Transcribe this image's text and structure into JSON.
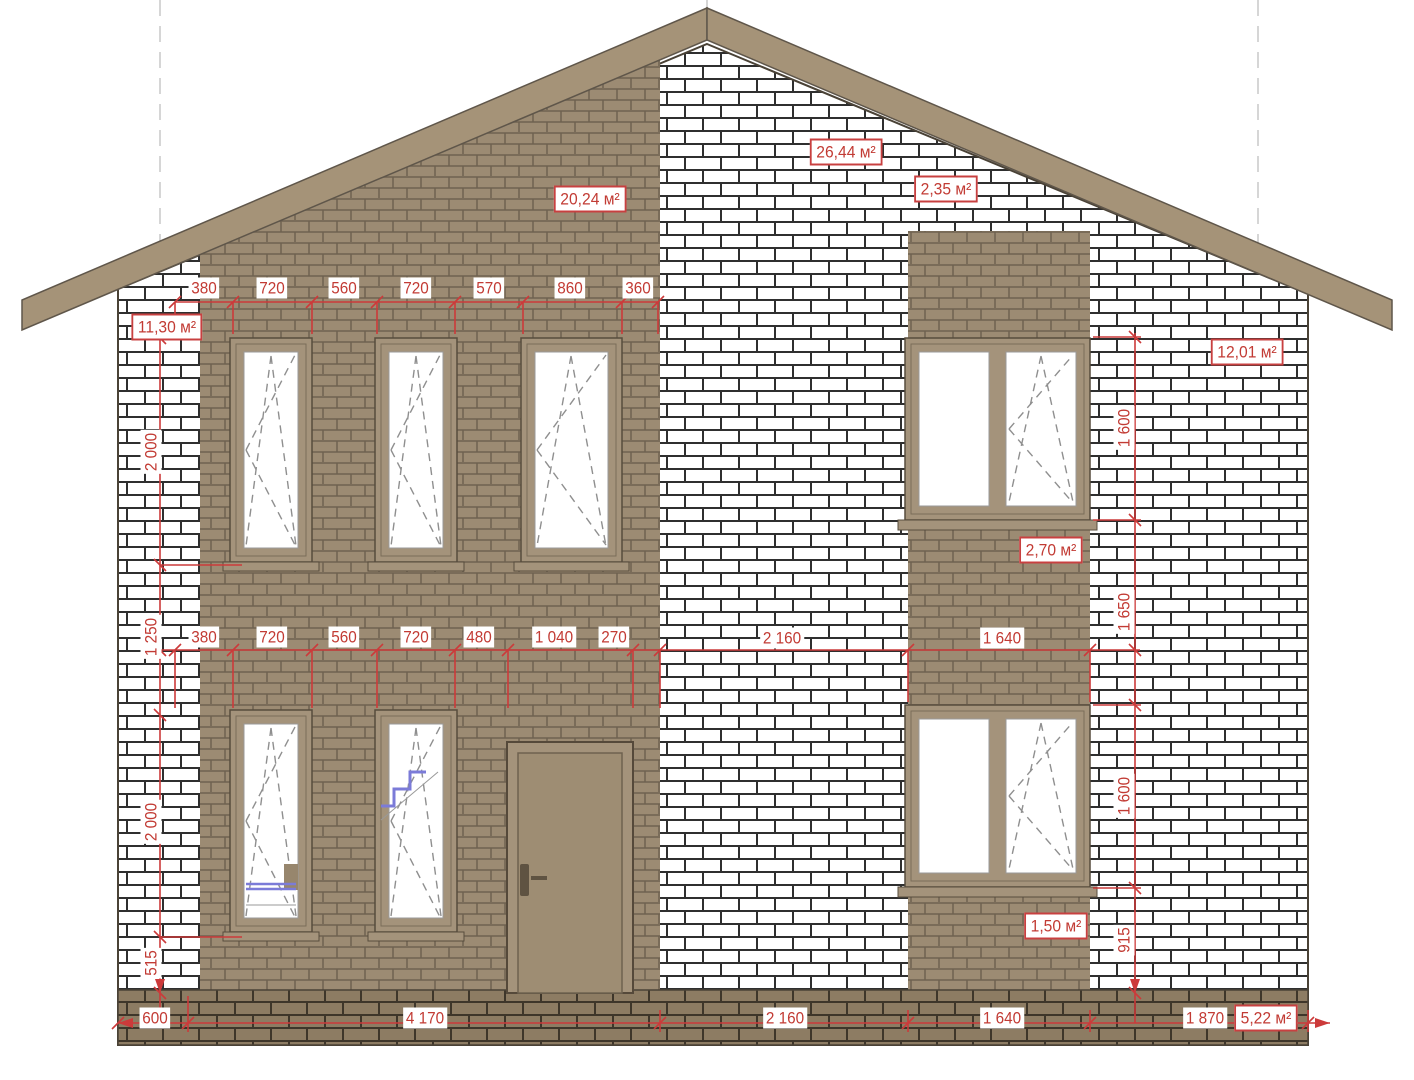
{
  "drawing": {
    "kind": "house facade elevation with brick cladding and dimensions",
    "units": "mm"
  },
  "dims": {
    "top": [
      "380",
      "720",
      "560",
      "720",
      "570",
      "860",
      "360"
    ],
    "middle": [
      "380",
      "720",
      "560",
      "720",
      "480",
      "1 040",
      "270",
      "2 160",
      "1 640"
    ],
    "bottom": [
      "600",
      "4 170",
      "2 160",
      "1 640",
      "1 870"
    ],
    "left": [
      "2 000",
      "1 250",
      "2 000",
      "515"
    ],
    "right": [
      "1 600",
      "1 650",
      "1 600",
      "915"
    ]
  },
  "areas": {
    "a1130": "11,30 м²",
    "a2024": "20,24 м²",
    "a2644": "26,44 м²",
    "a235": "2,35 м²",
    "a1201": "12,01 м²",
    "a270": "2,70 м²",
    "a150": "1,50 м²",
    "a522": "5,22 м²"
  },
  "colors": {
    "dimension_red": "#c23b34",
    "brick_tan": "#9c8b73",
    "brick_white": "#ffffff",
    "plinth_brown": "#8d7c63",
    "roof_tan": "#a59378",
    "stair_blue": "#7b7bd8"
  }
}
